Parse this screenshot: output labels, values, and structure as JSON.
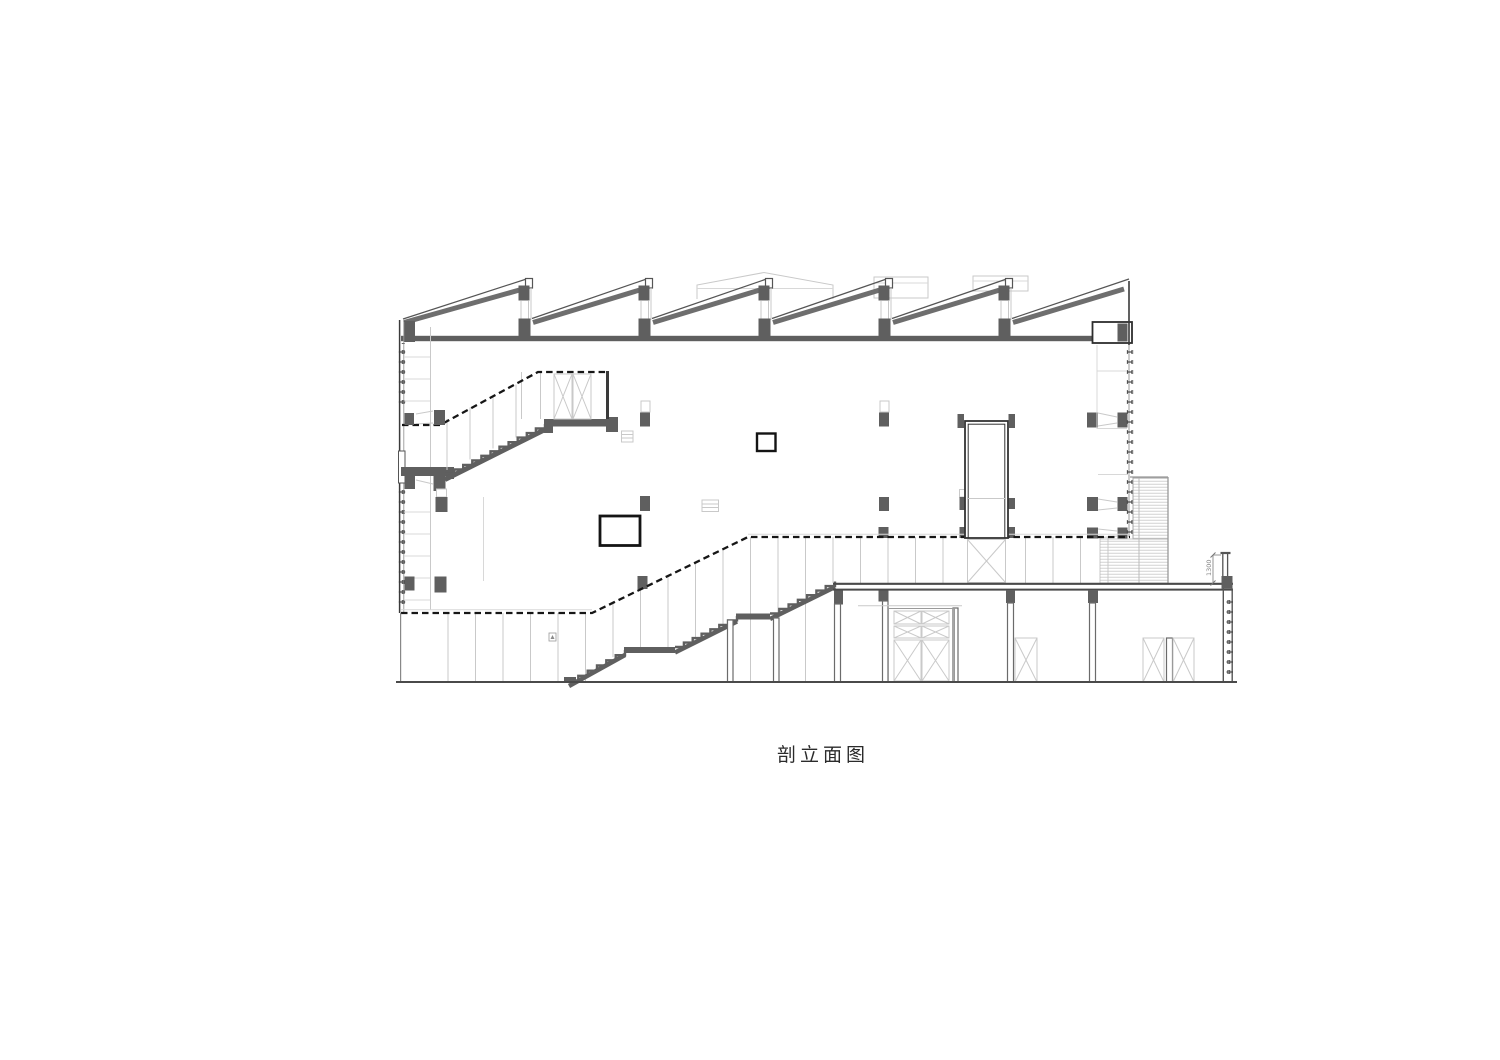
{
  "drawing": {
    "title": "剖立面图",
    "dimension_label": "1300"
  },
  "palette": {
    "background": "#ffffff",
    "cut_gray": "#5f5f5f",
    "beam_gray": "#6e6e6e",
    "line_dark": "#3a3a3a",
    "line_light": "#c9c9c9",
    "dashed_black": "#161616",
    "title_color": "#2b2b2b"
  }
}
